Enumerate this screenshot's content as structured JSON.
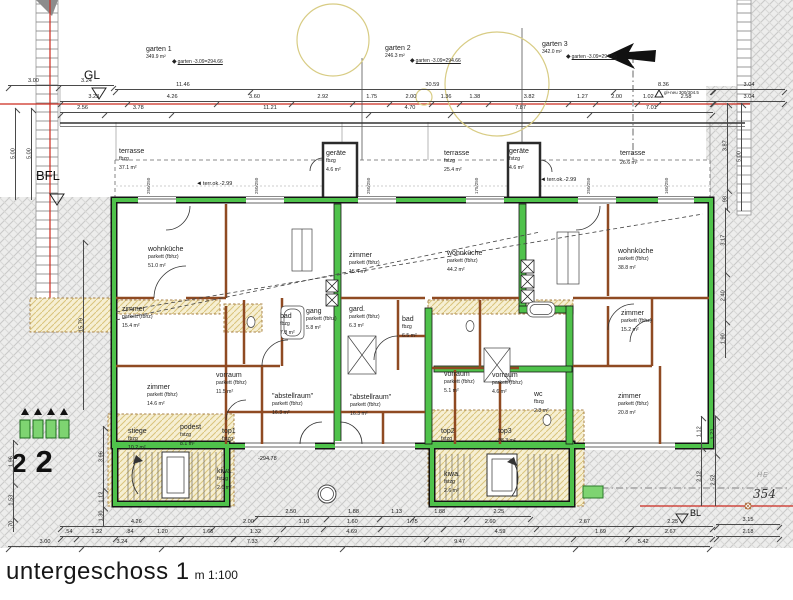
{
  "title": {
    "main": "untergeschoss 1",
    "scale": "m 1:100"
  },
  "gardens": [
    {
      "name": "garten 1",
      "area": "349.9 m²",
      "level": "garten -3.09=294.66"
    },
    {
      "name": "garten 2",
      "area": "246.3 m²",
      "level": "garten -3.09=294.66"
    },
    {
      "name": "garten 3",
      "area": "342.0 m²",
      "level": "garten -3.09=294.66"
    }
  ],
  "rooms": [
    {
      "label": "wohnküche",
      "finish": "parkett (fbhz)",
      "area": "51.0 m²"
    },
    {
      "label": "zimmer",
      "finish": "parkett (fbhz)",
      "area": "15.4 m²"
    },
    {
      "label": "zimmer",
      "finish": "parkett (fbhz)",
      "area": "14.6 m²"
    },
    {
      "label": "vorraum",
      "finish": "parkett (fbhz)",
      "area": "11.5 m²"
    },
    {
      "label": "bad",
      "finish": "fbzg",
      "area": "7.8 m²"
    },
    {
      "label": "gang",
      "finish": "parkett (fbhz)",
      "area": "5.8 m²"
    },
    {
      "label": "gard.",
      "finish": "parkett (fbhz)",
      "area": "6.3 m²"
    },
    {
      "label": "zimmer",
      "finish": "parkett (fbhz)",
      "area": "15.4 m²"
    },
    {
      "label": "wohnküche",
      "finish": "parkett (fbhz)",
      "area": "44.2 m²"
    },
    {
      "label": "bad",
      "finish": "fbzg",
      "area": "6.5 m²"
    },
    {
      "label": "\"abstellraum\"",
      "finish": "parkett (fbhz)",
      "area": "16.3 m²"
    },
    {
      "label": "\"abstellraum\"",
      "finish": "parkett (fbhz)",
      "area": "16.3 m²"
    },
    {
      "label": "wohnküche",
      "finish": "parkett (fbhz)",
      "area": "38.8 m²"
    },
    {
      "label": "zimmer",
      "finish": "parkett (fbhz)",
      "area": "15.2 m²"
    },
    {
      "label": "zimmer",
      "finish": "parkett (fbhz)",
      "area": "20.8 m²"
    },
    {
      "label": "vorraum",
      "finish": "parkett (fbhz)",
      "area": "5.1 m²"
    },
    {
      "label": "vorraum",
      "finish": "parkett (fbhz)",
      "area": "4.6 m²"
    },
    {
      "label": "wc",
      "finish": "fbzg",
      "area": "2.8 m²"
    },
    {
      "label": "stiege",
      "finish": "fbzg",
      "area": "10.2 m²"
    },
    {
      "label": "podest",
      "finish": "fstzg",
      "area": "8.1 m²"
    },
    {
      "label": "top1",
      "finish": "fstzg",
      "area": ""
    },
    {
      "label": "kiwa.",
      "finish": "fstzg",
      "area": "2.6 m²"
    },
    {
      "label": "top2",
      "finish": "fstzg",
      "area": ""
    },
    {
      "label": "top3",
      "finish": "",
      "area": "98.3 m²"
    },
    {
      "label": "kiwa.",
      "finish": "fstzg",
      "area": "2.6 m²"
    },
    {
      "label": "terrasse",
      "finish": "fbzg",
      "area": "37.1 m²"
    },
    {
      "label": "geräte",
      "finish": "fbzg",
      "area": "4.6 m²"
    },
    {
      "label": "terrasse",
      "finish": "fstzg",
      "area": "25.4 m²"
    },
    {
      "label": "geräte",
      "finish": "fstzg",
      "area": "4.6 m²"
    },
    {
      "label": "terrasse",
      "finish": "",
      "area": "26.6 m²"
    }
  ],
  "markers": {
    "gl": "GL",
    "bfl": "BFL",
    "bl": "BL",
    "boundary_point": "354",
    "he": "HE",
    "terr_level": "terr.ok.-2.99",
    "terr_level2": "terr.ok.-2.99",
    "floor_level": "-294.78",
    "gl_neu": "gl+neu 300/304.5",
    "unit_no_1": "2",
    "unit_no_2": "2"
  },
  "icons": {
    "tri_left": "◄",
    "diamond": "◆"
  },
  "window_tags": [
    "250/250",
    "250/250",
    "250/250",
    "175/250",
    "250/250",
    "160/250"
  ],
  "dim_chains": {
    "top_a": [
      "3.00",
      "3.24"
    ],
    "top_b": [
      "11.46",
      "30.59",
      "8.36"
    ],
    "top_c": [
      "3.23",
      "4.26",
      "3.60",
      "2.92",
      "1.75",
      "2.00",
      "1.36",
      "1.38",
      "3.82",
      "1.27",
      "2.00",
      "1.02",
      "2.58"
    ],
    "top_d": [
      "2.56",
      "3.78",
      "11.21",
      "4.70",
      "7.87",
      "7.01"
    ],
    "top_right_a": [
      "3.04"
    ],
    "top_right_b": [
      "3.04"
    ],
    "bottom_a": [
      "2.50",
      "1.88",
      "1.13",
      "1.88",
      "2.25"
    ],
    "bottom_b": [
      "4.26",
      "2.00",
      "1.10",
      "1.60",
      "1.75",
      "2.60",
      "2.67",
      "2.25"
    ],
    "bottom_c": [
      ".54",
      "1.22",
      ".84",
      "1.20",
      "1.65",
      "1.32",
      "4.69",
      "4.59",
      "1.69",
      "2.67"
    ],
    "bottom_d": [
      "3.00",
      "3.24",
      "7.33",
      "9.47",
      "5.42"
    ],
    "bottom_right_a": [
      "3.15"
    ],
    "bottom_right_b": [
      "2.18"
    ],
    "left_a": [
      "5.00"
    ],
    "left_b": [
      "5.00"
    ],
    "left_c": [
      "1.96",
      "1.53",
      ".70"
    ],
    "left_d": [
      "3.96",
      "1.12",
      "1.30"
    ],
    "left_e": [
      "15.79"
    ],
    "right_a": [
      "5.00"
    ],
    "right_b": [
      "3.87",
      ".98"
    ],
    "right_c": [
      "1.12",
      "2.12"
    ],
    "right_d": [
      "1.72",
      "2.52"
    ],
    "right_e": [
      "3.17",
      "2.40",
      "1.90"
    ]
  },
  "colors": {
    "wall_green": "#4fc24b",
    "wall_brown": "#8f4a22",
    "boundary_red": "#cc2a1f",
    "demolition_tan": "#d9c47c",
    "tree_yellow": "#d8cc84",
    "paving_hatch": "#c9c9c8"
  }
}
